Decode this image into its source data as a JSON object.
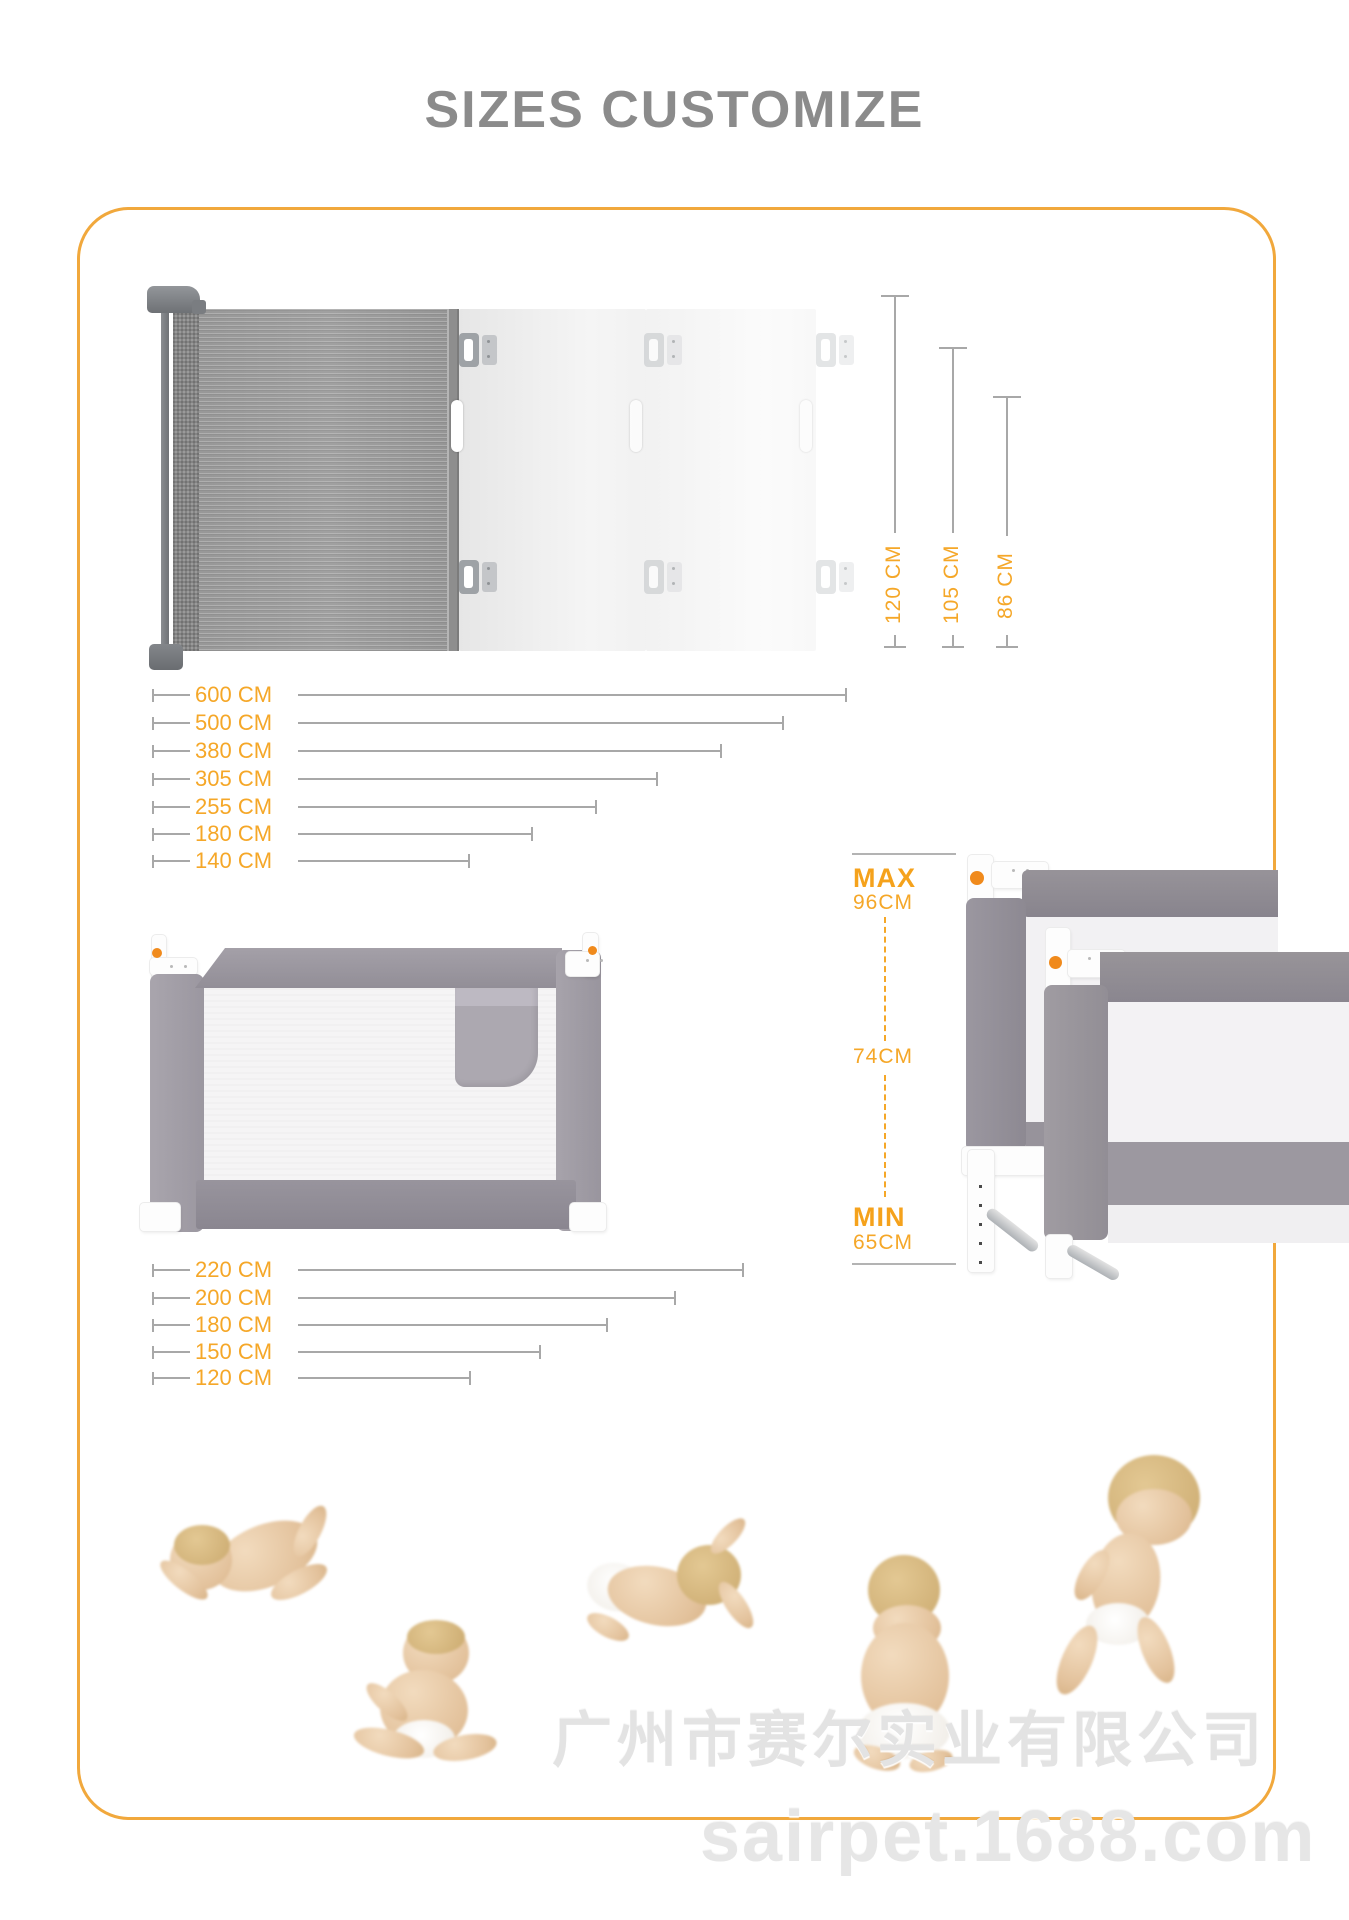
{
  "title": "SIZES CUSTOMIZE",
  "gate": {
    "height_labels": [
      "120 CM",
      "105 CM",
      "86 CM"
    ],
    "width_labels": [
      "600 CM",
      "500 CM",
      "380 CM",
      "305 CM",
      "255 CM",
      "180 CM",
      "140 CM"
    ]
  },
  "bedrail": {
    "width_labels": [
      "220 CM",
      "200 CM",
      "180 CM",
      "150 CM",
      "120 CM"
    ],
    "max_label": "MAX",
    "max_value": "96CM",
    "mid_value": "74CM",
    "min_label": "MIN",
    "min_value": "65CM"
  },
  "watermark": {
    "company": "广州市赛尔实业有限公司",
    "site": "sairpet.1688.com"
  },
  "colors": {
    "accent_orange": "#F5A728",
    "border_yellow": "#F1A83C",
    "title_gray": "#8B8B8B",
    "line_gray": "#A8A8A8",
    "fabric_gray": "#9B97A0"
  }
}
